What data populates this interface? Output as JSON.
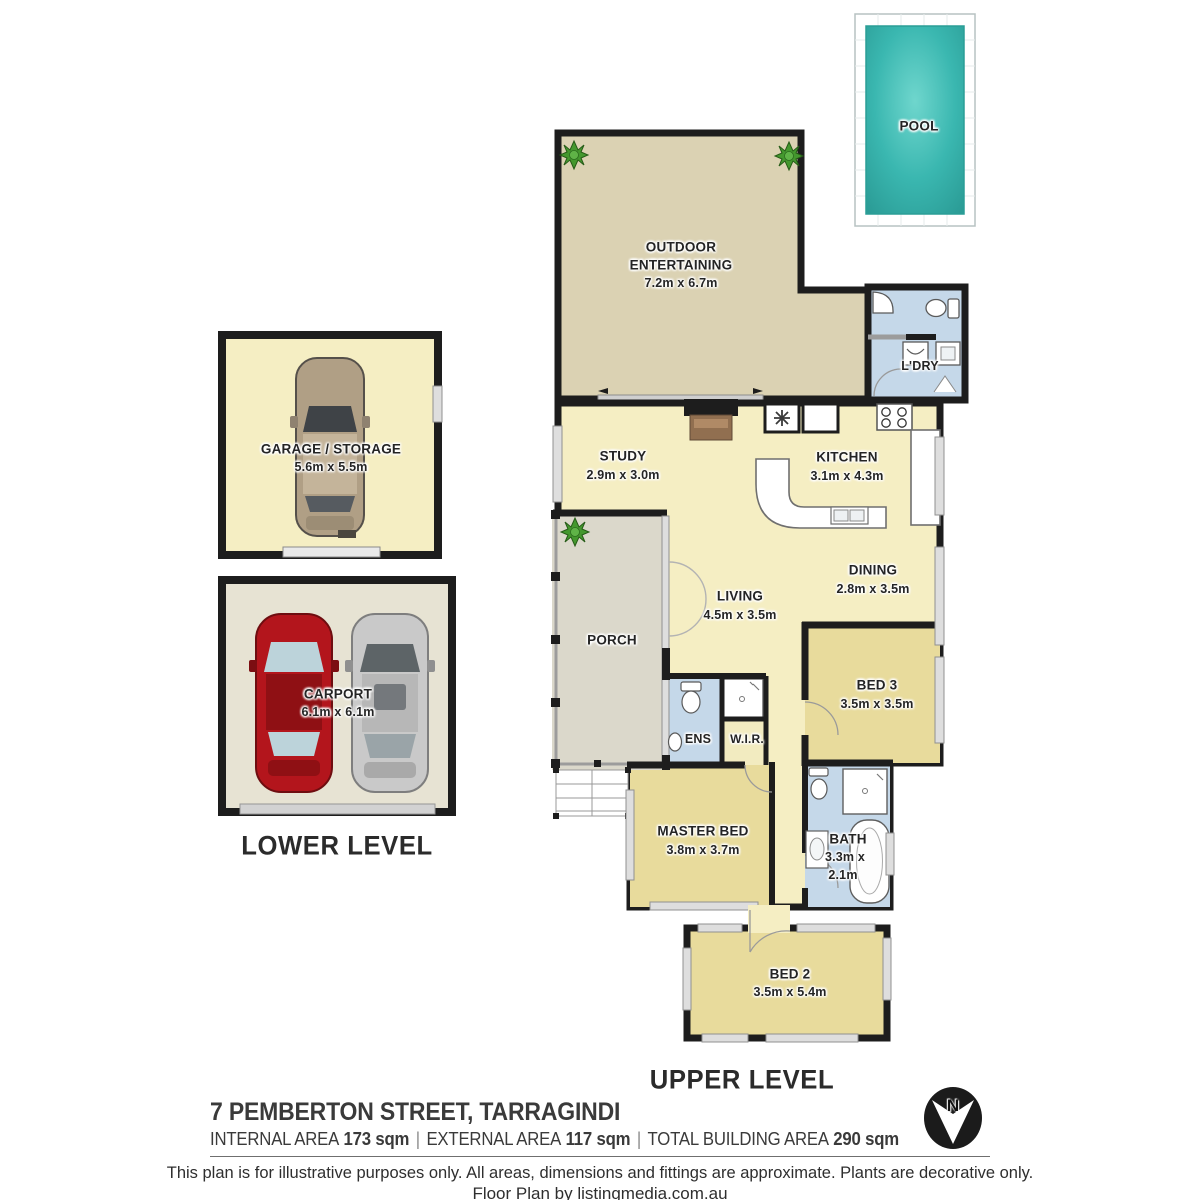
{
  "rooms": {
    "pool": {
      "label": "POOL"
    },
    "outdoor": {
      "label1": "OUTDOOR",
      "label2": "ENTERTAINING",
      "dims": "7.2m x 6.7m"
    },
    "laundry": {
      "label": "L'DRY"
    },
    "study": {
      "label": "STUDY",
      "dims": "2.9m x 3.0m"
    },
    "kitchen": {
      "label": "KITCHEN",
      "dims": "3.1m x 4.3m"
    },
    "living": {
      "label": "LIVING",
      "dims": "4.5m x 3.5m"
    },
    "dining": {
      "label": "DINING",
      "dims": "2.8m x 3.5m"
    },
    "porch": {
      "label": "PORCH"
    },
    "bed3": {
      "label": "BED 3",
      "dims": "3.5m x 3.5m"
    },
    "ens": {
      "label": "ENS"
    },
    "wir": {
      "label": "W.I.R."
    },
    "master": {
      "label": "MASTER BED",
      "dims": "3.8m x 3.7m"
    },
    "bath": {
      "label": "BATH",
      "dims_line1": "3.3m x",
      "dims_line2": "2.1m"
    },
    "bed2": {
      "label": "BED 2",
      "dims": "3.5m x 5.4m"
    },
    "garage": {
      "label": "GARAGE / STORAGE",
      "dims": "5.6m x 5.5m"
    },
    "carport": {
      "label": "CARPORT",
      "dims": "6.1m x 6.1m"
    }
  },
  "levels": {
    "lower": "LOWER LEVEL",
    "upper": "UPPER LEVEL"
  },
  "footer": {
    "address": "7 PEMBERTON STREET, TARRAGINDI",
    "internal_label": "INTERNAL AREA",
    "internal_value": "173 sqm",
    "external_label": "EXTERNAL AREA",
    "external_value": "117 sqm",
    "total_label": "TOTAL BUILDING AREA",
    "total_value": "290 sqm",
    "separator": "|",
    "disclaimer": "This plan is for illustrative purposes only. All areas, dimensions and fittings are approximate. Plants are decorative only.",
    "credit": "Floor Plan by listingmedia.com.au"
  },
  "compass": {
    "label": "N"
  },
  "colors": {
    "wall": "#1d1d1d",
    "interior_floor": "#f5eec3",
    "bedroom_floor": "#e8db9c",
    "outdoor_floor": "#dbd2b3",
    "porch_floor": "#dbd8cb",
    "wet_area_floor": "#c5d8e9",
    "carport_floor": "#e7e3d3",
    "pool_water": "#35b3ac",
    "window_band": "#dedede",
    "plant_green": "#44982e",
    "car_red": "#b3151c",
    "car_silver": "#c9c9c9",
    "car_tan": "#b09f85"
  }
}
